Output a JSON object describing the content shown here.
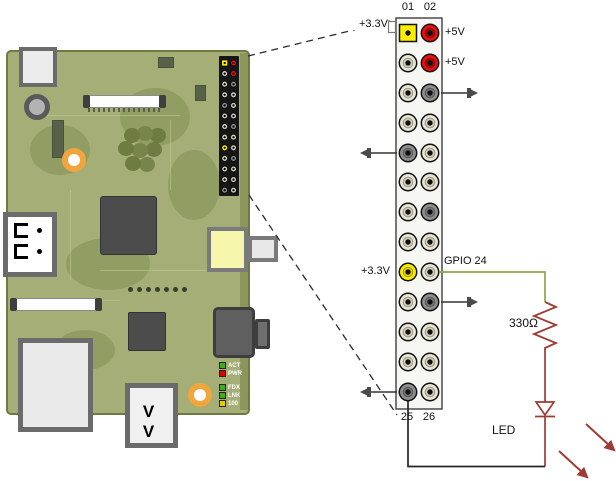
{
  "schematic": {
    "pin_numbers_top": [
      "01",
      "02"
    ],
    "pin_numbers_bottom": [
      "25",
      "26"
    ],
    "labels": {
      "v5_row1": "+5V",
      "v5_row2": "+5V",
      "v33_pin1": "+3.3V",
      "v33_pin17": "+3.3V",
      "gpio24": "GPIO 24",
      "resistor": "330Ω",
      "led": "LED"
    },
    "pins": [
      {
        "left": "yellow",
        "left_shape": "square",
        "right": "red"
      },
      {
        "left": "beige",
        "right": "red"
      },
      {
        "left": "beige",
        "right": "gray",
        "gnd": "right"
      },
      {
        "left": "beige",
        "right": "beige"
      },
      {
        "left": "gray",
        "right": "beige",
        "gnd": "left"
      },
      {
        "left": "beige",
        "right": "beige"
      },
      {
        "left": "beige",
        "right": "gray"
      },
      {
        "left": "beige",
        "right": "beige"
      },
      {
        "left": "yellow",
        "right": "beige"
      },
      {
        "left": "beige",
        "right": "gray",
        "gnd": "right"
      },
      {
        "left": "beige",
        "right": "beige"
      },
      {
        "left": "beige",
        "right": "beige"
      },
      {
        "left": "gray",
        "right": "beige",
        "gnd": "left"
      }
    ],
    "colors": {
      "beige": "#e8e5d2",
      "gray": "#8e8e8e",
      "red": "#ee0f0f",
      "yellow": "#ffee00",
      "wire_green": "#8fa64a",
      "component_red": "#9e3b33",
      "wire_black": "#262626"
    }
  },
  "board": {
    "pcb_color": "#a5ae76",
    "status_leds": [
      {
        "label": "ACT",
        "color": "#44aa22"
      },
      {
        "label": "PWR",
        "color": "#dd0000"
      },
      {
        "label": "FDX",
        "color": "#44aa22"
      },
      {
        "label": "LNK",
        "color": "#44aa22"
      },
      {
        "label": "100",
        "color": "#e3cf00"
      }
    ]
  }
}
